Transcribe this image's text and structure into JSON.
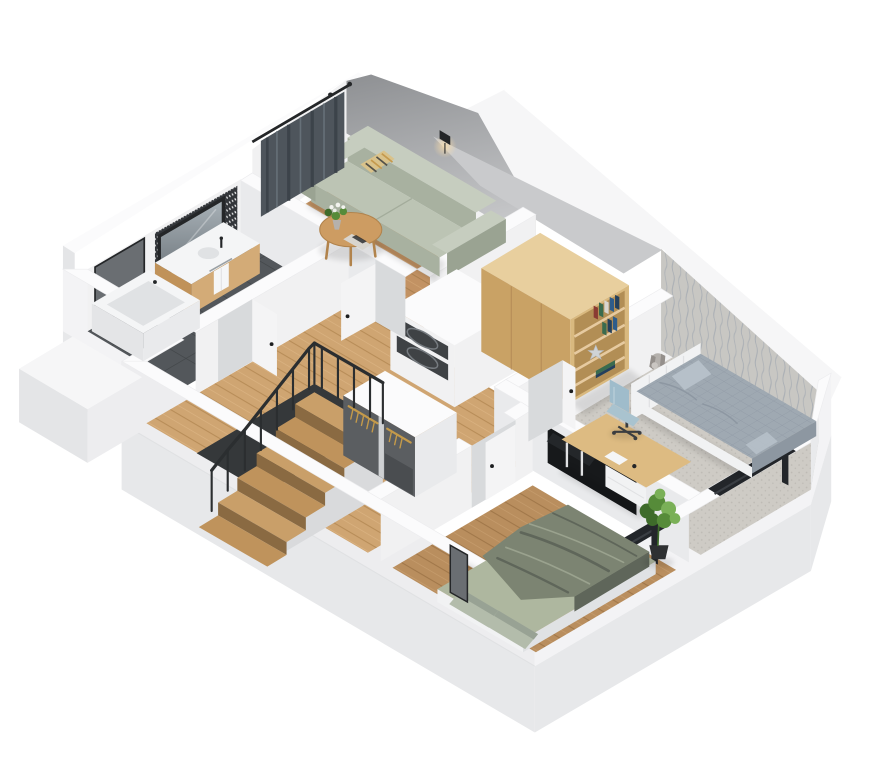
{
  "meta": {
    "title": "3D isometric cutaway floor plan of an attic apartment",
    "description": "Photoreal dollhouse-style render: bathroom, living room, hallway with staircase, utility closet, open wardrobe, kids bedroom and master bedroom, white walls, wood floors, no visible text."
  },
  "palette": {
    "bg": "#ffffff",
    "wall_top": "#fbfbfc",
    "ext_bright": "#f3f3f5",
    "ext_mid": "#ededef",
    "ext_dim": "#e4e5e7",
    "ext_dark": "#d9dadc",
    "plinth": "#e7e8ea",
    "plinth_dark": "#dfe0e2",
    "roof": "#f6f6f7",
    "slope_hi": "#8e9093",
    "slope_lo": "#c6c7c9",
    "terrace": "#c9cacc",
    "int_bright": "#f1f1f2",
    "int_shade": "#e9eaec",
    "opening": "#d8dadc",
    "wood_a": "#c29263",
    "wood_a_seam": "#a87e4e",
    "wood_b": "#cfa572",
    "wood_b_seam": "#b58a55",
    "wood_c": "#b98e5e",
    "wood_c_seam": "#9e7547",
    "stair_wood": "#c99f69",
    "stair_wood2": "#bf935c",
    "riser": "#8a6a42",
    "pit": "#35383a",
    "tile": "#53575b",
    "tile_line": "#43474a",
    "carpet": "#cecbc5",
    "carpet_dot": "#bdbab4",
    "wp": "#c8c7c3",
    "wp_line": "#a9aeb4",
    "sofa": "#bcc4b4",
    "sofa_hi": "#c6cdbf",
    "sofa_sh": "#a8b1a0",
    "sofa_dk": "#9aa392",
    "pillow_a": "#d9c28a",
    "pillow_b": "#54524a",
    "pillow_c": "#c59a4e",
    "table": "#cd9c62",
    "table_dk": "#b1834c",
    "curtain": "#4e555c",
    "curtain_dk": "#3c434a",
    "curtain_hi": "#667078",
    "frame": "#242628",
    "glass_a": "#aab3b9",
    "glass_b": "#70787e",
    "mosaic": "#33363a",
    "glasspanel": "#6a6e72",
    "vanity": "#d3ab77",
    "vanity_dk": "#c09259",
    "fixture": "#f4f5f6",
    "fixture_sh": "#e0e2e4",
    "towel": "#f5f6f7",
    "washer_door": "#3f4245",
    "washer_glass": "#767b80",
    "ward_face": "#d9b97f",
    "ward_top": "#e8cf9e",
    "ward_side": "#c9a265",
    "shelf": "#b28e55",
    "shelf_board": "#e6caa0",
    "bk_navy": "#24405c",
    "bk_blue": "#2e5c8a",
    "bk_green": "#3a6b4e",
    "bk_red": "#8a3b33",
    "bk_white": "#d8d5cf",
    "plush": "#b5b1ad",
    "plush_dk": "#948f8b",
    "kduvet": "#9fa9b2",
    "kduvet_ln": "#8d97a2",
    "kduvet_dk": "#8d97a1",
    "kpillow": "#b6c0c9",
    "bedframe": "#f1f2f3",
    "desk": "#ddbb82",
    "chair": "#a9c3cf",
    "chair_dk": "#9fbccb",
    "chair_base": "#3a3d40",
    "tv": "#17191b",
    "tv_hi": "#2b2f33",
    "leaf_dk": "#3e6b2a",
    "leaf": "#568b39",
    "leaf_hi": "#7ab057",
    "pot": "#2e3032",
    "mduvet": "#7c8472",
    "mduvet_dk": "#5f665a",
    "mduvet_hi": "#9aa28e",
    "sheet": "#aeb79f",
    "mpillow": "#b3bcab",
    "mpillow_sh": "#98a294",
    "closet_bg": "#5b5e61",
    "closet_dk": "#4a4d50",
    "closet_div": "#cfd1d3",
    "brass": "#c49a4a",
    "rail": "#2b2e30",
    "door": "#f4f4f5",
    "door_edge": "#e0e1e3",
    "handle": "#1b1d1f",
    "win": "#23262a",
    "win_in": "#3a3e43"
  },
  "scene": {
    "style": "isometric-cutaway",
    "floor": "attic level",
    "rooms": [
      {
        "name": "bathroom",
        "items": [
          "bathtub",
          "vanity-sink",
          "mirror",
          "mosaic-tile-strip",
          "towel",
          "dark-tile-floor",
          "shower-panel"
        ]
      },
      {
        "name": "living-room",
        "items": [
          "sofa",
          "striped-pillow",
          "coffee-table",
          "flowers",
          "books",
          "wall-lamp",
          "curtain",
          "sloped-attic-ceiling",
          "wood-floor"
        ]
      },
      {
        "name": "hallway",
        "items": [
          "staircase",
          "black-railing",
          "open-closet-with-brass-hangers",
          "doors",
          "wood-floor"
        ]
      },
      {
        "name": "utility-closet",
        "items": [
          "stacked-washer-dryer"
        ]
      },
      {
        "name": "kids-bedroom",
        "items": [
          "single-bed",
          "gray-quilt",
          "bookshelf-wardrobe",
          "plush-dog",
          "desk",
          "blue-desk-chair",
          "wavy-wallpaper",
          "carpet-floor",
          "window"
        ]
      },
      {
        "name": "master-bedroom",
        "items": [
          "double-bed",
          "green-duvet",
          "pillows",
          "tv",
          "potted-plant",
          "leaning-mirror",
          "window",
          "wood-floor"
        ]
      }
    ]
  }
}
